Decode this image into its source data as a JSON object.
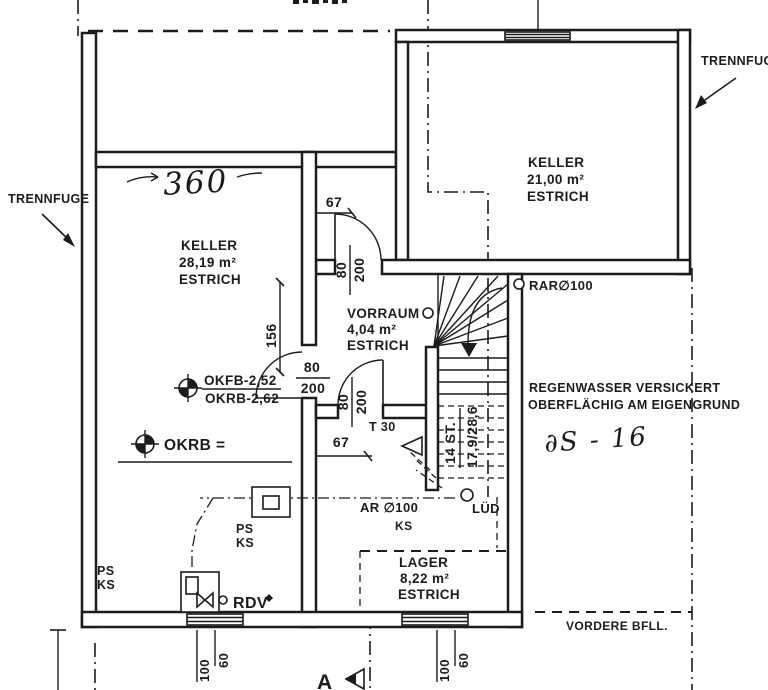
{
  "colors": {
    "ink": "#1c1c1c",
    "paper": "#ffffff"
  },
  "plan": {
    "rooms": {
      "keller_left": {
        "name": "KELLER",
        "area": "28,19 m²",
        "floor": "ESTRICH"
      },
      "keller_right": {
        "name": "KELLER",
        "area": "21,00 m²",
        "floor": "ESTRICH"
      },
      "vorraum": {
        "name": "VORRAUM",
        "area": "4,04 m²",
        "floor": "ESTRICH"
      },
      "lager": {
        "name": "LAGER",
        "area": "8,22 m²",
        "floor": "ESTRICH"
      }
    },
    "labels": {
      "trennfuge": "TRENNFUGE",
      "vordere_bfll": "VORDERE BFLL.",
      "regenwasser_1": "REGENWASSER VERSICKERT",
      "regenwasser_2": "OBERFLÄCHIG AM EIGENGRUND",
      "rar": "RAR∅100",
      "ar": "AR ∅100",
      "lued": "LÜD",
      "rdv": "RDV",
      "t30": "T 30",
      "ps": "PS",
      "ks": "KS",
      "okfb": "OKFB-2,52",
      "okrb": "OKRB-2,62",
      "okrb_eq": "OKRB =",
      "section": "A"
    },
    "dimensions": {
      "d67": "67",
      "d156": "156",
      "door_w": "80",
      "door_h": "200",
      "win_w": "100",
      "win_h": "60",
      "stair_count": "14 ST.",
      "stair_ratio": "17,9/28,6"
    },
    "handwritten": {
      "wall_length": "360",
      "note": "∂S - 16"
    }
  }
}
